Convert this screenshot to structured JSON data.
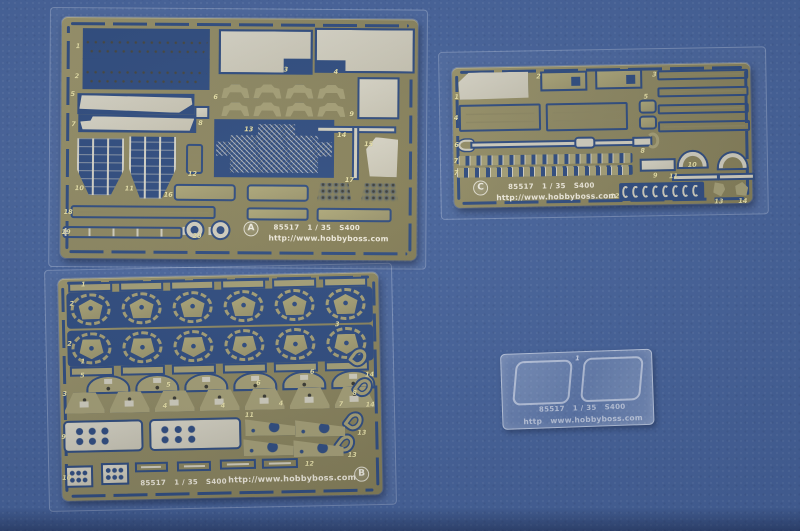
{
  "colors": {
    "bg": "#45629a",
    "cut": "#2e4b7e",
    "olive": "#8c8660",
    "olivel": "#a49e74",
    "metal": "#d0cdbd",
    "num": "#e8e1a6",
    "white": "#efeadb"
  },
  "fret_a": {
    "letter": "A",
    "code": "85517",
    "scale": "1 / 35",
    "kit": "S400",
    "url": "http://www.hobbyboss.com",
    "labels": [
      "1",
      "2",
      "3",
      "4",
      "5",
      "6",
      "7",
      "8",
      "9",
      "10",
      "11",
      "12",
      "13",
      "14",
      "15",
      "16",
      "17",
      "18",
      "19",
      "20"
    ]
  },
  "fret_b": {
    "letter": "B",
    "code": "85517",
    "scale": "1 / 35",
    "kit": "S400",
    "url": "http://www.hobbyboss.com",
    "labels": [
      "1",
      "2",
      "3",
      "4",
      "5",
      "6",
      "7",
      "8",
      "9",
      "10",
      "11",
      "12",
      "13",
      "14"
    ]
  },
  "fret_c": {
    "letter": "C",
    "code": "85517",
    "scale": "1 / 35",
    "kit": "S400",
    "url": "http://www.hobbyboss.com",
    "labels": [
      "1",
      "2",
      "3",
      "4",
      "5",
      "6",
      "7",
      "8",
      "9",
      "10",
      "11",
      "12",
      "13",
      "14"
    ]
  },
  "film": {
    "code": "85517",
    "scale": "1 / 35",
    "kit": "S400",
    "url": "http   www.hobbyboss.com",
    "labels": [
      "1"
    ]
  }
}
